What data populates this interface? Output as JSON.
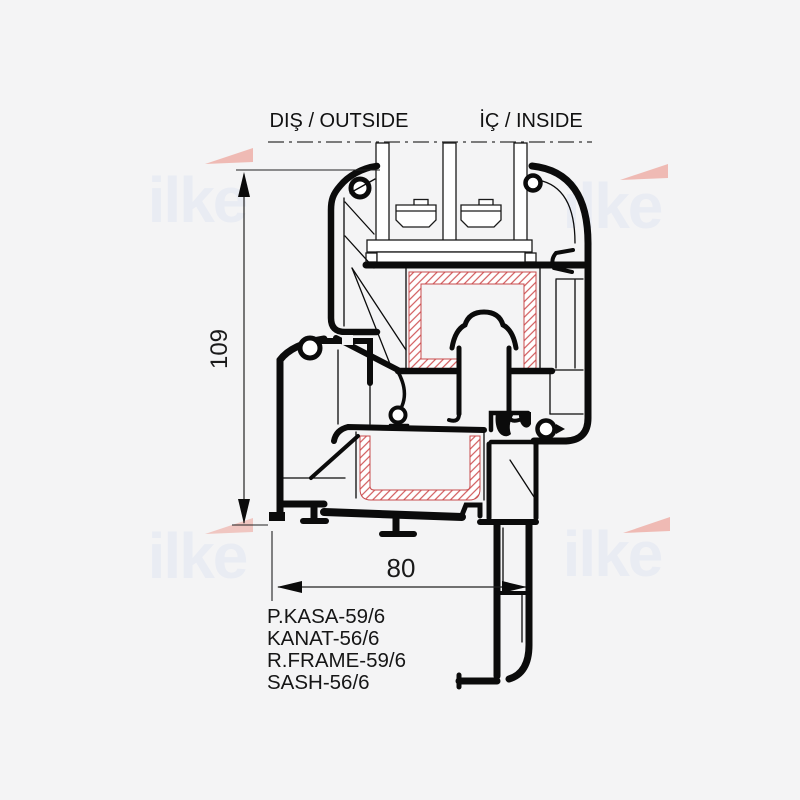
{
  "drawing": {
    "title": "window-profile-cross-section",
    "side_labels": {
      "outside": "DIŞ / OUTSIDE",
      "inside": "İÇ / INSIDE"
    },
    "dimensions": {
      "height": "109",
      "width": "80"
    },
    "profile_labels": [
      "P.KASA-59/6",
      "KANAT-56/6",
      "R.FRAME-59/6",
      "SASH-56/6"
    ],
    "watermark": {
      "text": "ilke"
    },
    "colors": {
      "background": "#f4f4f5",
      "line": "#0b0b0b",
      "hatch_red": "#d15a5c",
      "hatch_outline": "#c94b4d",
      "watermark_text": "#e9ecf3",
      "watermark_accent": "#eda79e"
    }
  }
}
